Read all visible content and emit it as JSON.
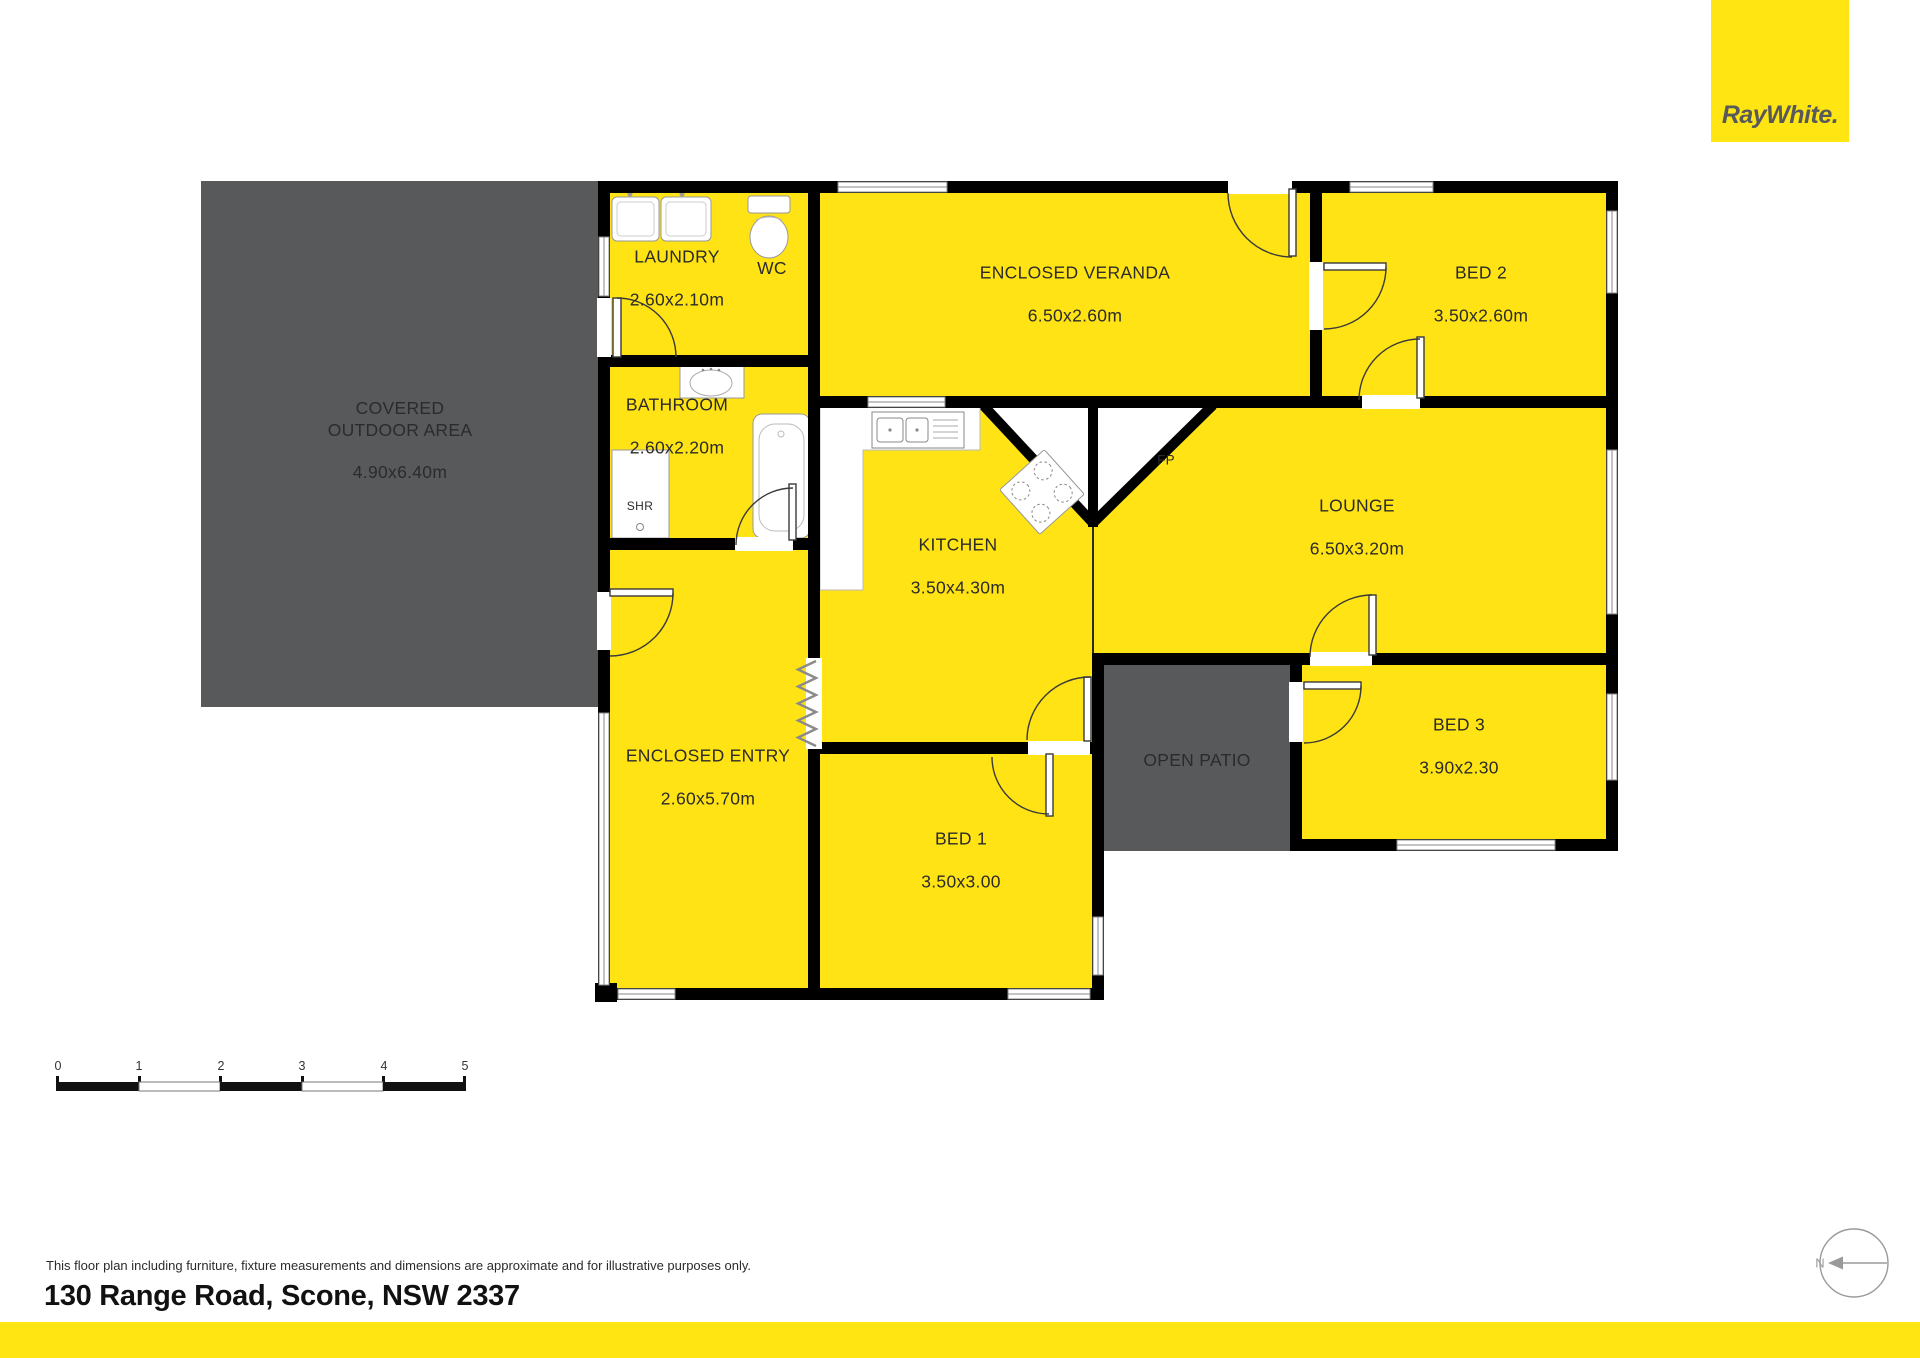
{
  "page": {
    "width": 1920,
    "height": 1358,
    "background": "#FFFFFF"
  },
  "brand": {
    "logo": "RayWhite.",
    "logo_bg": "#FFE512",
    "logo_color": "#58595B",
    "footer_bar_color": "#FFE512"
  },
  "colors": {
    "room_fill": "#FFE315",
    "outdoor_fill": "#58595B",
    "wall": "#000000",
    "label_text": "#2B2B2B"
  },
  "rooms": {
    "covered_outdoor": {
      "name": "COVERED\nOUTDOOR AREA",
      "dims": "4.90x6.40m"
    },
    "laundry": {
      "name": "LAUNDRY",
      "dims": "2.60x2.10m"
    },
    "wc": {
      "name": "WC"
    },
    "bathroom": {
      "name": "BATHROOM",
      "dims": "2.60x2.20m"
    },
    "shower": {
      "name": "SHR"
    },
    "enclosed_veranda": {
      "name": "ENCLOSED VERANDA",
      "dims": "6.50x2.60m"
    },
    "bed2": {
      "name": "BED 2",
      "dims": "3.50x2.60m"
    },
    "kitchen": {
      "name": "KITCHEN",
      "dims": "3.50x4.30m"
    },
    "lounge": {
      "name": "LOUNGE",
      "dims": "6.50x3.20m"
    },
    "fireplace": {
      "name": "FP"
    },
    "enclosed_entry": {
      "name": "ENCLOSED ENTRY",
      "dims": "2.60x5.70m"
    },
    "bed1": {
      "name": "BED 1",
      "dims": "3.50x3.00"
    },
    "open_patio": {
      "name": "OPEN PATIO"
    },
    "bed3": {
      "name": "BED 3",
      "dims": "3.90x2.30"
    }
  },
  "scale_bar": {
    "labels": [
      "0",
      "1",
      "2",
      "3",
      "4",
      "5"
    ]
  },
  "compass": {
    "label": "N"
  },
  "footer": {
    "disclaimer": "This floor plan including furniture, fixture measurements and dimensions are approximate and for illustrative purposes only.",
    "address": "130 Range Road, Scone, NSW 2337"
  }
}
